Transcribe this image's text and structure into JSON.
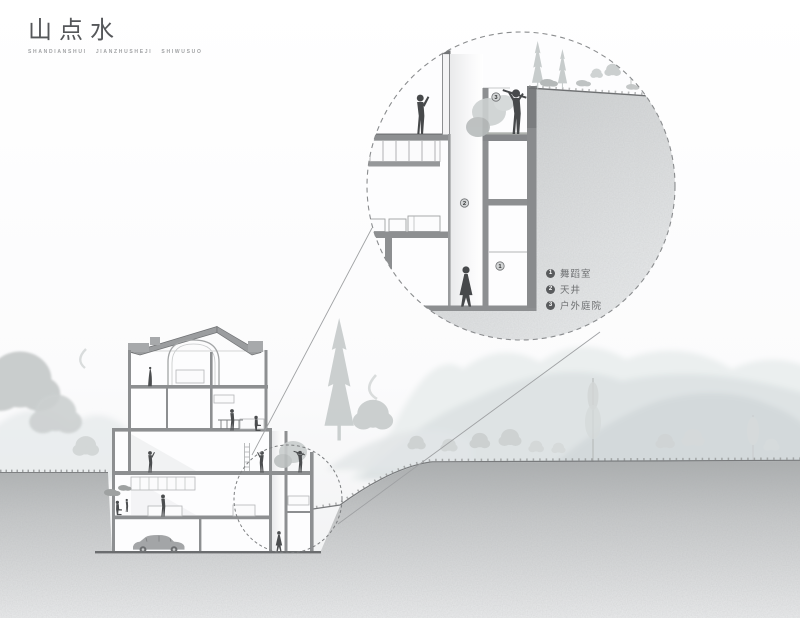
{
  "page": {
    "title": "山点水",
    "caption": "SHANDIANSHUI JIANZHUSHEJI SHIWUSUO"
  },
  "detail_view": {
    "legend": [
      {
        "num": "1",
        "label": "舞蹈室"
      },
      {
        "num": "2",
        "label": "天井"
      },
      {
        "num": "3",
        "label": "户外庭院"
      }
    ],
    "callouts": {
      "outdoor_court": "3",
      "atrium": "2",
      "dance_room": "1"
    }
  },
  "colors": {
    "line": "#6f7173",
    "wall": "#8d8f91",
    "figure": "#4b4d4f",
    "tree": "#c8cccc",
    "ground_dark": "#aeb1b2",
    "ground_light": "#ebecec"
  }
}
